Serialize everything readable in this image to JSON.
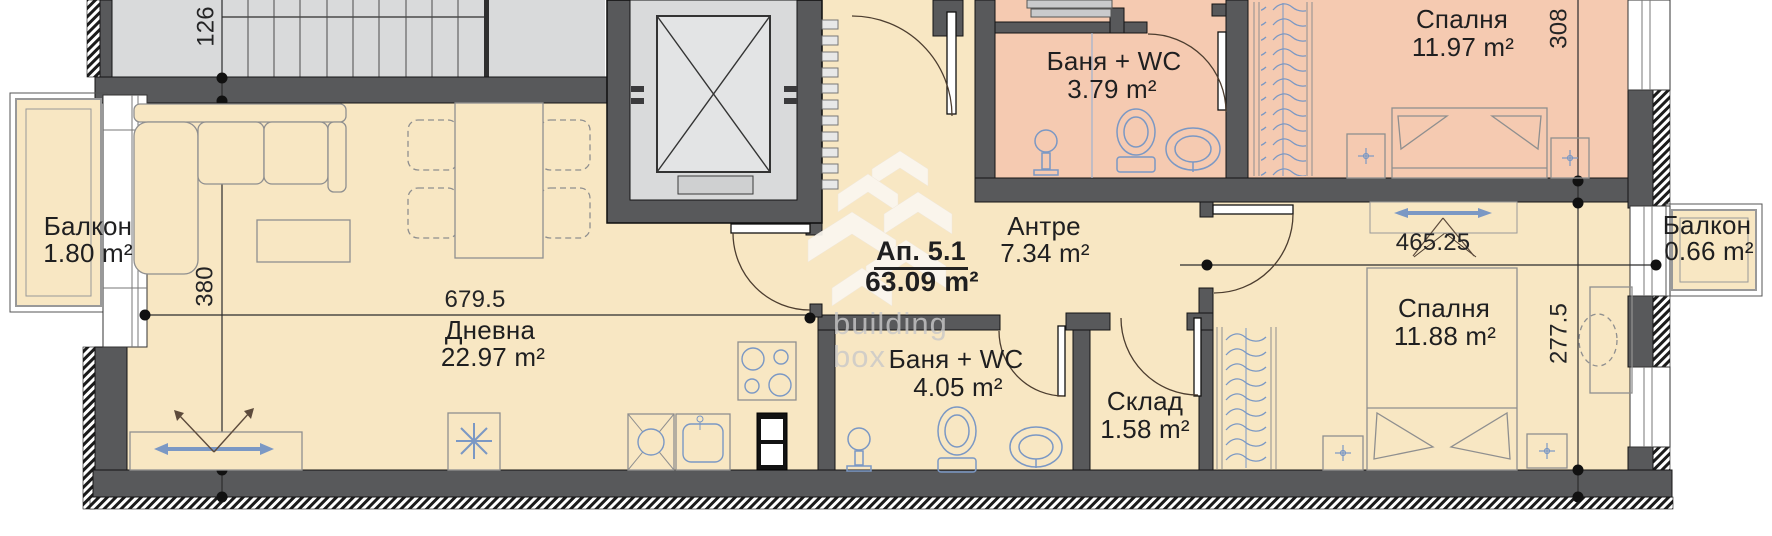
{
  "title": "Apartment floor plan",
  "apartment": {
    "id": "Ап. 5.1",
    "area": "63.09 m²"
  },
  "rooms": {
    "balcony_left": {
      "name": "Балкон",
      "area": "1.80 m²"
    },
    "living": {
      "name": "Дневна",
      "area": "22.97 m²"
    },
    "bath_top": {
      "name": "Баня + WC",
      "area": "3.79 m²"
    },
    "hall": {
      "name": "Антре",
      "area": "7.34 m²"
    },
    "bedroom_top": {
      "name": "Спалня",
      "area": "11.97 m²"
    },
    "bath_bottom": {
      "name": "Баня + WC",
      "area": "4.05 m²"
    },
    "storage": {
      "name": "Склад",
      "area": "1.58 m²"
    },
    "bedroom_right": {
      "name": "Спалня",
      "area": "11.88 m²"
    },
    "balcony_right": {
      "name": "Балкон",
      "area": "0.66 m²"
    }
  },
  "dimensions": {
    "stair_flight_width": "126",
    "living_depth": "380",
    "living_width": "679.5",
    "bedroom_top_depth": "308",
    "bedroom_right_width": "465.25",
    "bedroom_right_depth": "277.5"
  },
  "watermark": {
    "line1": "building",
    "line2": "box"
  },
  "colors": {
    "room_cream": "#F8E7C3",
    "room_pink": "#F5CAB1",
    "core_gray": "#D9DADB",
    "wall_gray": "#58595B",
    "furniture_blue": "#7B98C4",
    "furniture_gray": "#8F8F8F",
    "text": "#1F1F20"
  }
}
